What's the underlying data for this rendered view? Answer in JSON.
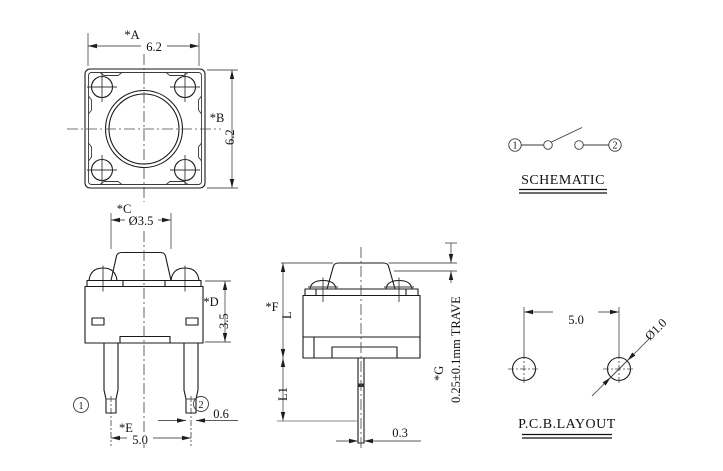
{
  "drawing": {
    "top_view": {
      "dim_a_label": "*A",
      "dim_a_value": "6.2",
      "dim_b_label": "*B",
      "dim_b_value": "6.2"
    },
    "front_view": {
      "dim_c_label": "*C",
      "dim_c_value": "Ø3.5",
      "dim_d_label": "*D",
      "dim_d_value": "3.5",
      "dim_e_label": "*E",
      "dim_e_value": "5.0",
      "lead_width_value": "0.6",
      "pin1": "1",
      "pin2": "2"
    },
    "side_view": {
      "dim_f_label": "*F",
      "dim_f_value": "L",
      "dim_l1_value": "L1",
      "dim_g_label": "*G",
      "travel_value": "0.25±0.1mm TRAVE",
      "lead_thickness_value": "0.3"
    },
    "schematic": {
      "title": "SCHEMATIC",
      "pin1": "1",
      "pin2": "2"
    },
    "pcb_layout": {
      "title": "P.C.B.LAYOUT",
      "pitch_value": "5.0",
      "hole_diameter_value": "Ø1.0"
    }
  },
  "colors": {
    "background": "#ffffff",
    "line": "#1a1a1a"
  }
}
